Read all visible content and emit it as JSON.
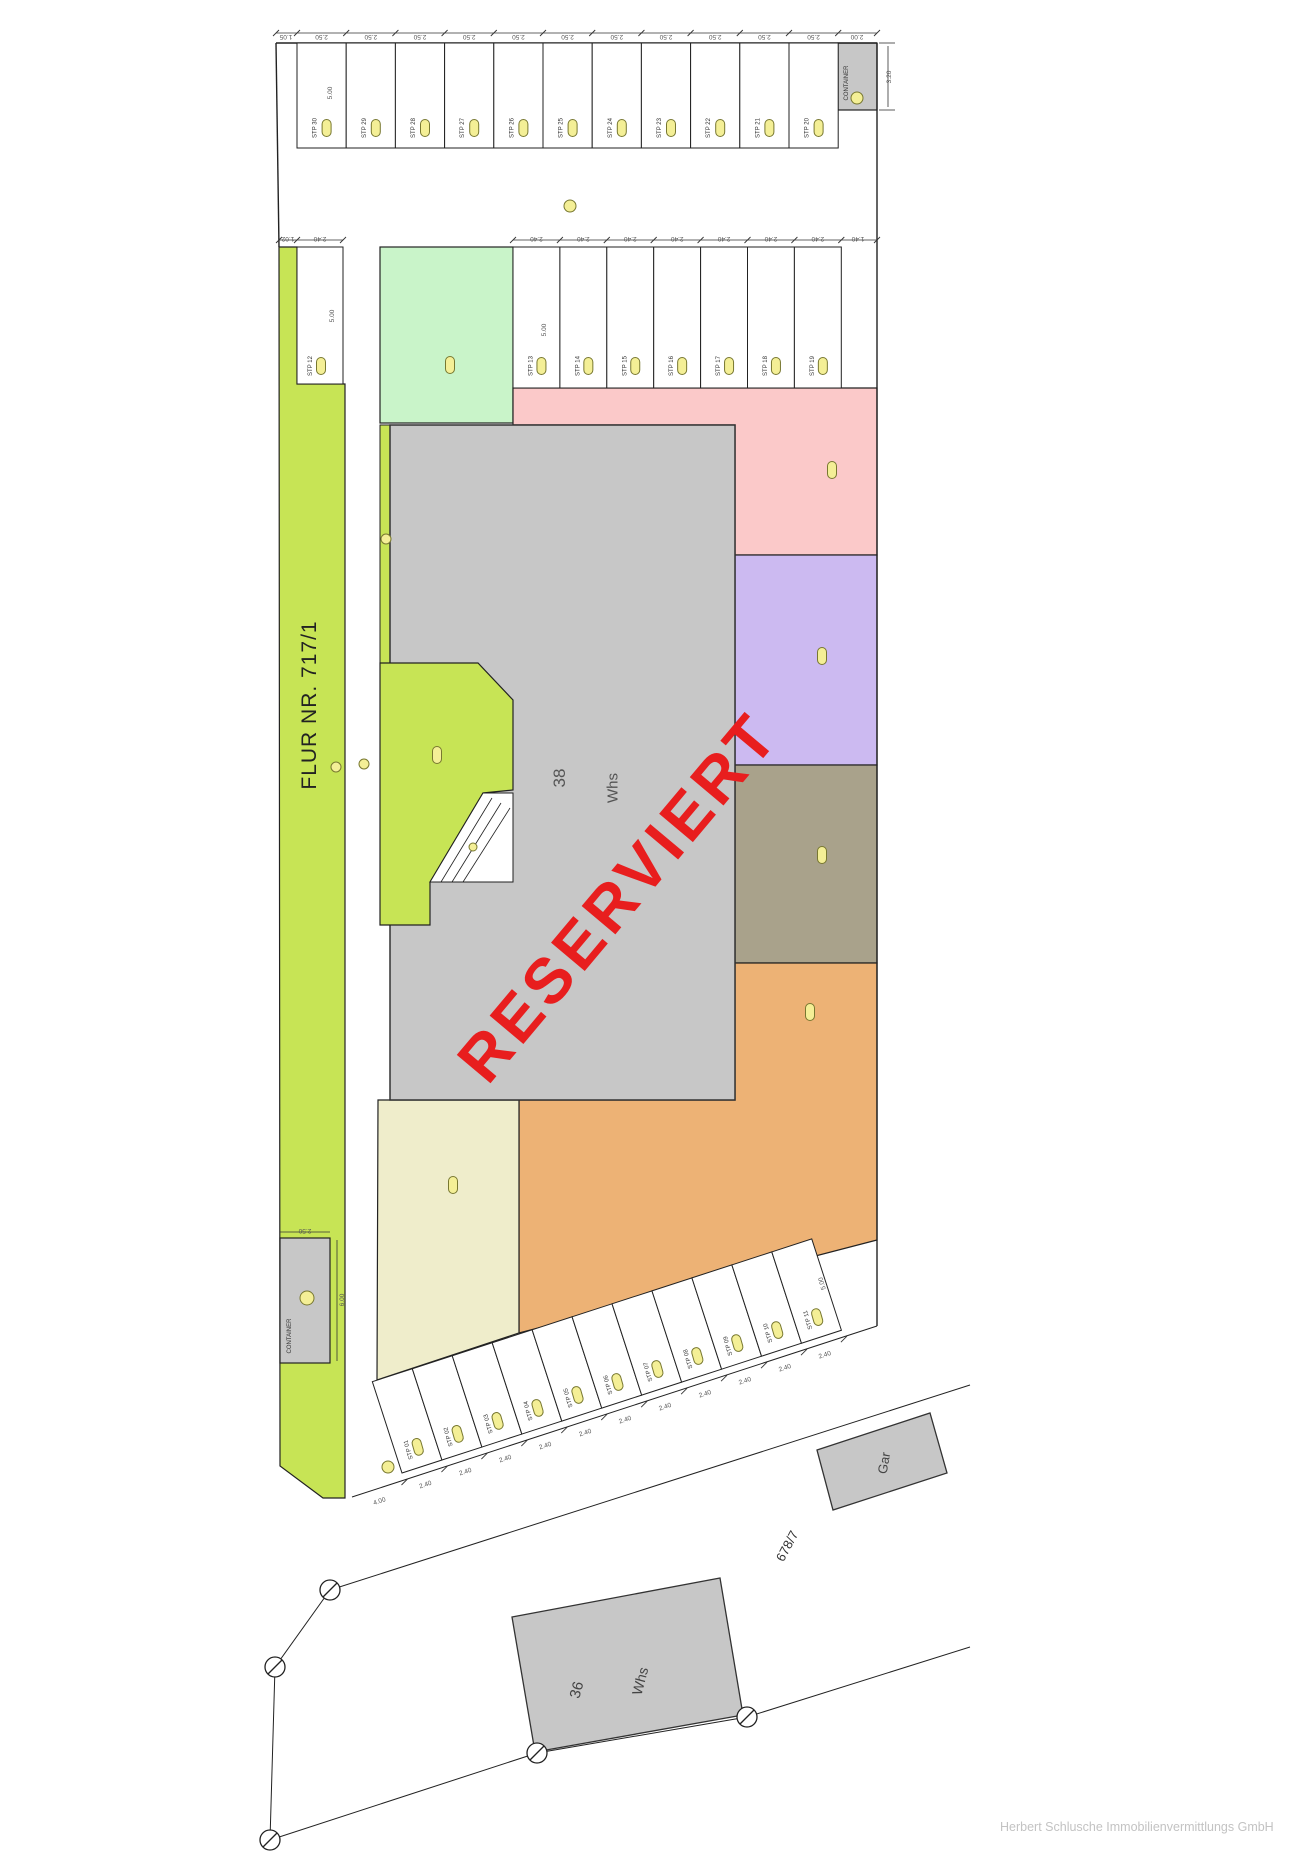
{
  "site": {
    "watermark": "RESERVIERT",
    "footer": "Herbert Schlusche Immobilienvermittlungs GmbH",
    "flur_label": "FLUR NR. 717/1",
    "parcel_label": "678/7"
  },
  "buildings": {
    "main": {
      "number": "38",
      "type": "Whs"
    },
    "neighbor": {
      "number": "36",
      "type": "Whs"
    },
    "garage": {
      "label": "Gar"
    },
    "container_top": {
      "label": "CONTAINER",
      "width_m": "2.00",
      "height_m": "3.20"
    },
    "container_left": {
      "label": "CONTAINER",
      "width_m": "2.50",
      "height_m": "6.00"
    }
  },
  "parking": {
    "badge_color": "#f4ef96",
    "top_row": {
      "labels": [
        "STP 30",
        "STP 29",
        "STP 28",
        "STP 27",
        "STP 26",
        "STP 25",
        "STP 24",
        "STP 23",
        "STP 22",
        "STP 21",
        "STP 20"
      ],
      "stall_width_m": "2.50",
      "lead_m": "1.05",
      "depth_m": "5.00"
    },
    "row2_left": {
      "labels": [
        "STP 12"
      ],
      "stall_width_m": "2.40",
      "lead_m": "1.02",
      "depth_m": "5.00"
    },
    "row2_right": {
      "labels": [
        "STP 13",
        "STP 14",
        "STP 15",
        "STP 16",
        "STP 17",
        "STP 18",
        "STP 19"
      ],
      "stall_width_m": "2.40",
      "end_m": "1.40",
      "depth_m": "5.00"
    },
    "diagonal_row": {
      "labels": [
        "STP 01",
        "STP 02",
        "STP 03",
        "STP 04",
        "STP 05",
        "STP 06",
        "STP 07",
        "STP 08",
        "STP 09",
        "STP 10",
        "STP 11"
      ],
      "stall_width_m": "2.40",
      "lead_m": "4.00",
      "depth_m": "5.00"
    }
  },
  "zones": {
    "flur_strip": "#c7e455",
    "playground": "#c7e455",
    "mint": "#c9f4c9",
    "pink": "#fbc9c9",
    "purple": "#ccbaf1",
    "olive": "#a9a28b",
    "orange": "#edb275",
    "cream": "#efedcb",
    "building_gray": "#c7c7c7",
    "watermark_red": "#e81e1e"
  },
  "extra_dims": [
    {
      "x": 286,
      "y": 35,
      "r": 180,
      "t": "1.05"
    },
    {
      "x": 857,
      "y": 35,
      "r": 180,
      "t": "2.00"
    },
    {
      "x": 332,
      "y": 93,
      "r": -90,
      "t": "5.00"
    },
    {
      "x": 891,
      "y": 77,
      "r": -90,
      "t": "3.20"
    },
    {
      "x": 288,
      "y": 237,
      "r": 180,
      "t": "1.02"
    },
    {
      "x": 320,
      "y": 237,
      "r": 180,
      "t": "2.40"
    },
    {
      "x": 334,
      "y": 316,
      "r": -90,
      "t": "5.00"
    },
    {
      "x": 858,
      "y": 237,
      "r": 180,
      "t": "1.40"
    },
    {
      "x": 546,
      "y": 330,
      "r": -90,
      "t": "5.00"
    },
    {
      "x": 305,
      "y": 1229,
      "r": 180,
      "t": "2.50"
    },
    {
      "x": 344,
      "y": 1300,
      "r": -90,
      "t": "6.00"
    },
    {
      "x": 824,
      "y": 1283,
      "r": -106,
      "t": "5.00"
    },
    {
      "x": 380,
      "y": 1503,
      "r": -18,
      "t": "4.00"
    }
  ]
}
